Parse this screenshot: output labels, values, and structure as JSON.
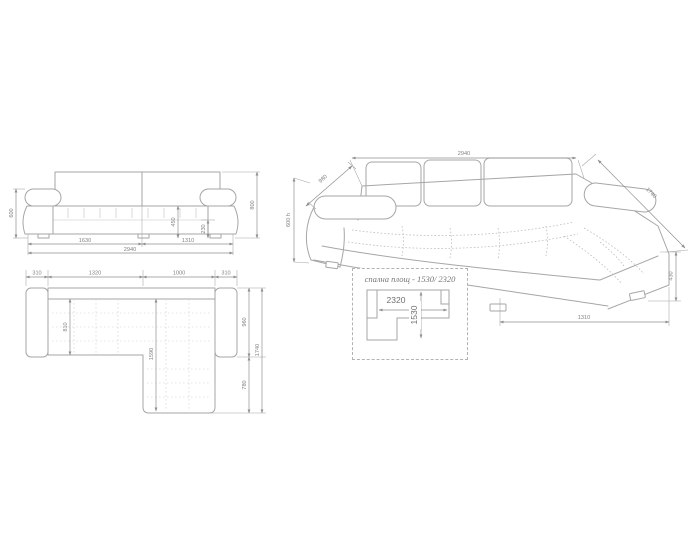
{
  "colors": {
    "line": "#a6a6a6",
    "dimension_text": "#828282"
  },
  "front_view": {
    "dim_height_left": "600",
    "dim_height_right": "800",
    "dim_seat_height": "450",
    "dim_base_height": "230",
    "dim_width_left": "1630",
    "dim_width_right": "1310",
    "dim_width_total": "2940"
  },
  "plan_view": {
    "dim_arm_left": "310",
    "dim_body_width": "1320",
    "dim_chaise_width": "1000",
    "dim_arm_right": "310",
    "dim_seat_depth": "810",
    "dim_inner_depth": "1590",
    "dim_depth_upper": "960",
    "dim_depth_lower": "780",
    "dim_depth_total": "1740"
  },
  "perspective_view": {
    "dim_width_total": "2940",
    "dim_back_segment": "980",
    "dim_height": "600 h",
    "dim_depth_total": "1740",
    "dim_base_height": "430",
    "dim_chaise_length": "1310"
  },
  "sleeping_area": {
    "note": "спална площ - 1530/ 2320",
    "dim_width": "2320",
    "dim_depth": "1530"
  }
}
